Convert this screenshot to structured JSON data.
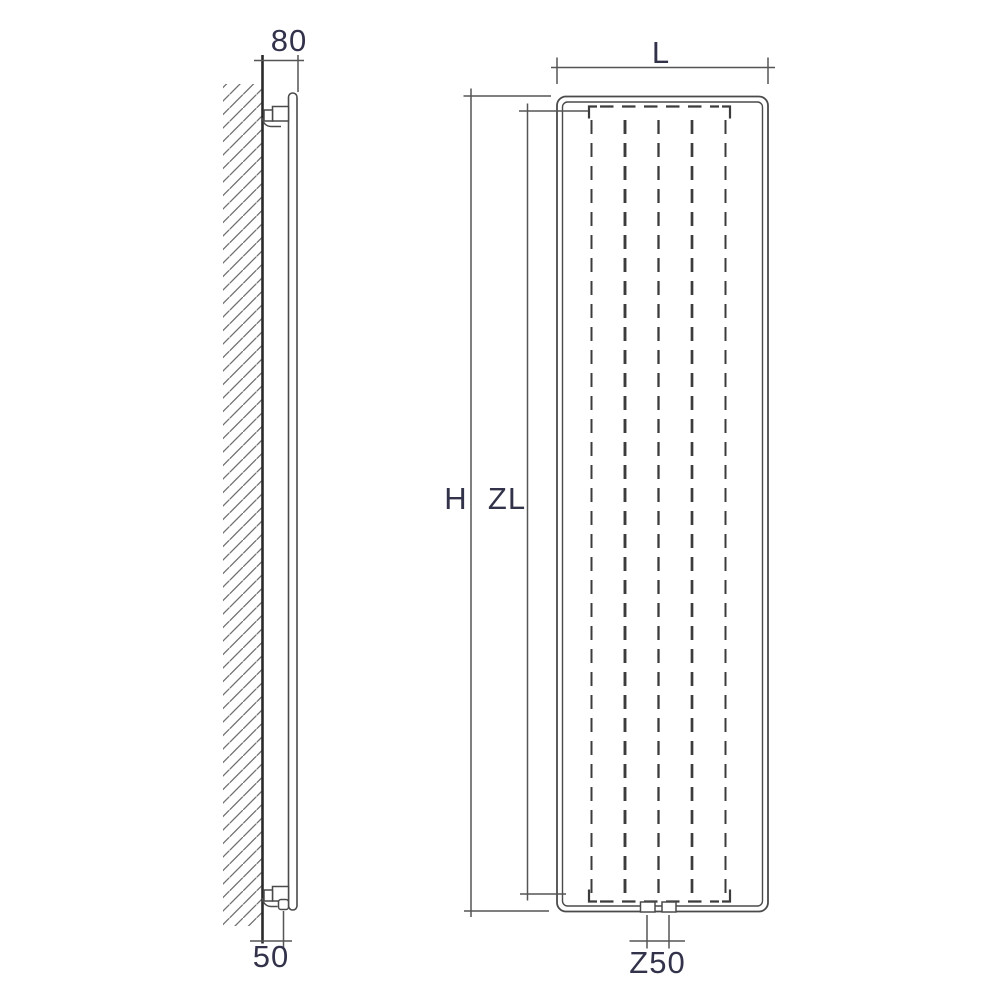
{
  "drawing": {
    "colors": {
      "background": "#ffffff",
      "line_color": "#4a4a4a",
      "wall_color": "#2a2a2a",
      "dim_color": "#555555",
      "dash_color": "#3c3c3c",
      "hatch_color": "#6f6f6f",
      "text_color": "#32324a"
    },
    "side_view": {
      "dims": {
        "wall_to_panel_front": "80",
        "wall_to_connection": "50"
      }
    },
    "front_view": {
      "dims": {
        "width": "L",
        "overall_height": "H",
        "convector_height": "ZL",
        "connection_spacing": "Z50"
      },
      "fin_count": 5,
      "connection_count": 2
    }
  }
}
